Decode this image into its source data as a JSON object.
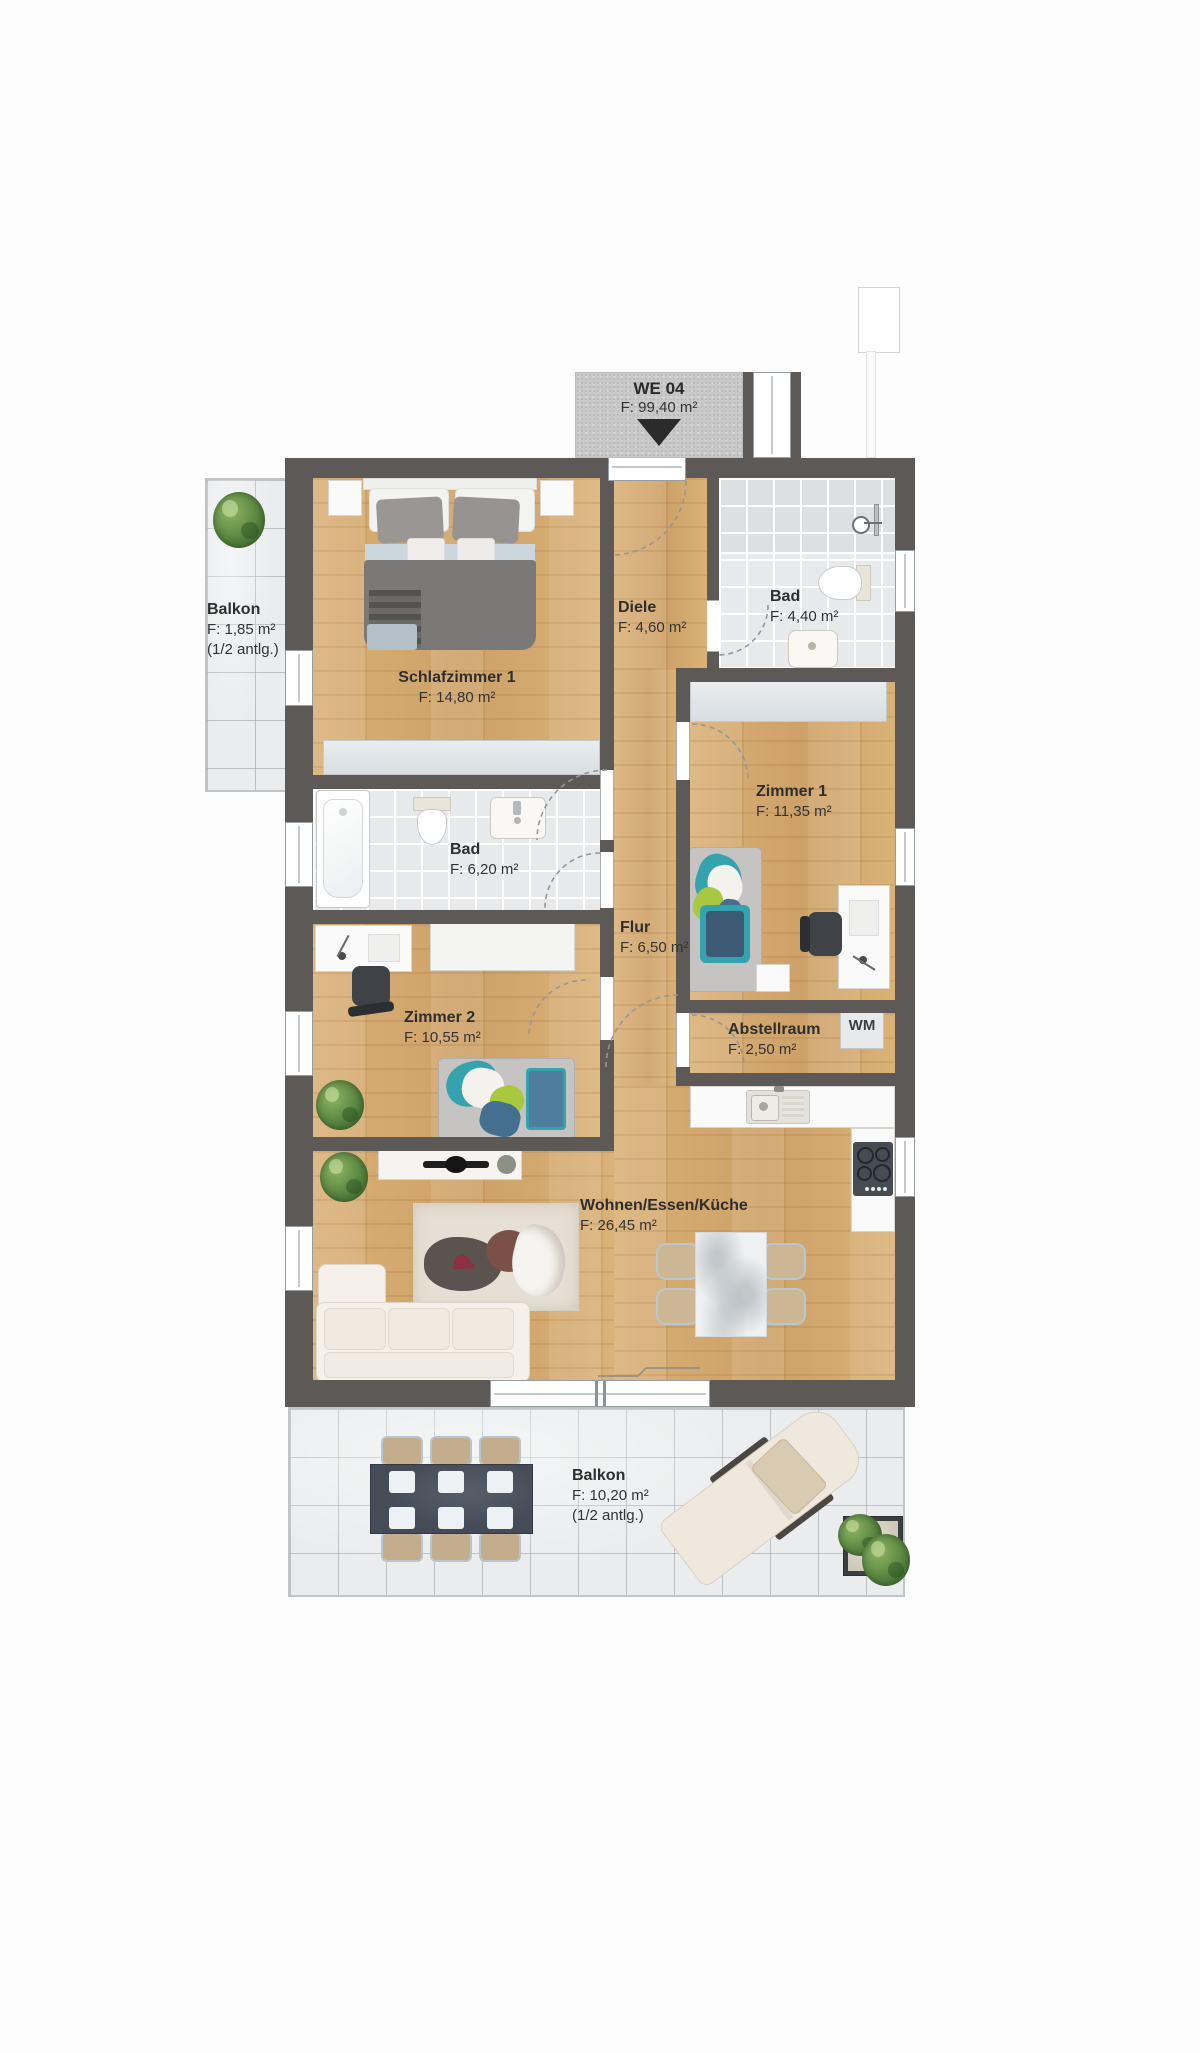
{
  "unit": {
    "id": "WE 04",
    "area": "F: 99,40 m²"
  },
  "rooms": {
    "balkon_top": {
      "name": "Balkon",
      "area": "F: 1,85 m²",
      "note": "(1/2 antlg.)"
    },
    "schlafzimmer1": {
      "name": "Schlafzimmer 1",
      "area": "F: 14,80 m²"
    },
    "diele": {
      "name": "Diele",
      "area": "F: 4,60 m²"
    },
    "bad_klein": {
      "name": "Bad",
      "area": "F: 4,40 m²"
    },
    "zimmer1": {
      "name": "Zimmer 1",
      "area": "F: 11,35 m²"
    },
    "bad_gross": {
      "name": "Bad",
      "area": "F: 6,20 m²"
    },
    "flur": {
      "name": "Flur",
      "area": "F: 6,50 m²"
    },
    "zimmer2": {
      "name": "Zimmer 2",
      "area": "F: 10,55 m²"
    },
    "abstellraum": {
      "name": "Abstellraum",
      "area": "F: 2,50 m²"
    },
    "wohnen_essen_kueche": {
      "name": "Wohnen/Essen/Küche",
      "area": "F: 26,45 m²"
    },
    "balkon_bottom": {
      "name": "Balkon",
      "area": "F: 10,20 m²",
      "note": "(1/2 antlg.)"
    }
  },
  "appliances": {
    "washing_machine": "WM"
  },
  "colors": {
    "wall": "#5d5956",
    "wood_floor": "#d5aa74",
    "bath_tile": "#e7e9ea",
    "balcony_tile": "#eaeced",
    "accent_teal": "#35a3ae",
    "accent_lime": "#a8c93f",
    "accent_blue": "#3d6f9e",
    "label_text": "#333333",
    "unit_box": "#c9c9c9"
  }
}
